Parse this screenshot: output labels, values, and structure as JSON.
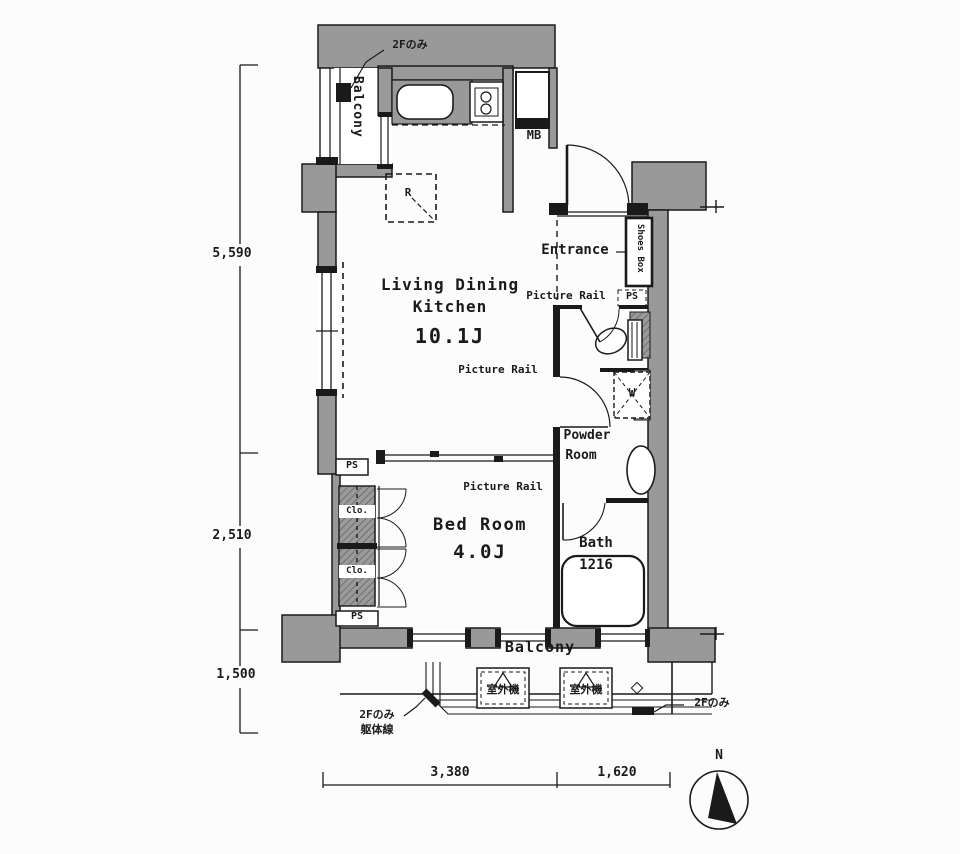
{
  "rooms": {
    "ldk_line1": "Living Dining",
    "ldk_line2": "Kitchen",
    "ldk_size": "10.1J",
    "bedroom_name": "Bed Room",
    "bedroom_size": "4.0J",
    "bath_name": "Bath",
    "bath_size": "1216",
    "powder_line1": "Powder",
    "powder_line2": "Room",
    "entrance": "Entrance",
    "balcony": "Balcony"
  },
  "fixtures": {
    "meter_box": "MB",
    "shoes_box": "Shoes Box",
    "refrigerator": "R",
    "washing_machine": "W",
    "closet": "Clo.",
    "pipe_space": "PS",
    "outdoor_unit": "室外機"
  },
  "notes": {
    "second_floor_only": "2Fのみ",
    "structure_line": "躯体線",
    "picture_rail": "Picture Rail",
    "north": "N"
  },
  "dimensions": {
    "left": [
      "5,590",
      "2,510",
      "1,500"
    ],
    "bottom": [
      "3,380",
      "1,620"
    ]
  },
  "colors": {
    "wall": "#999999",
    "line": "#1a1a1a",
    "background": "#fcfcfc"
  }
}
